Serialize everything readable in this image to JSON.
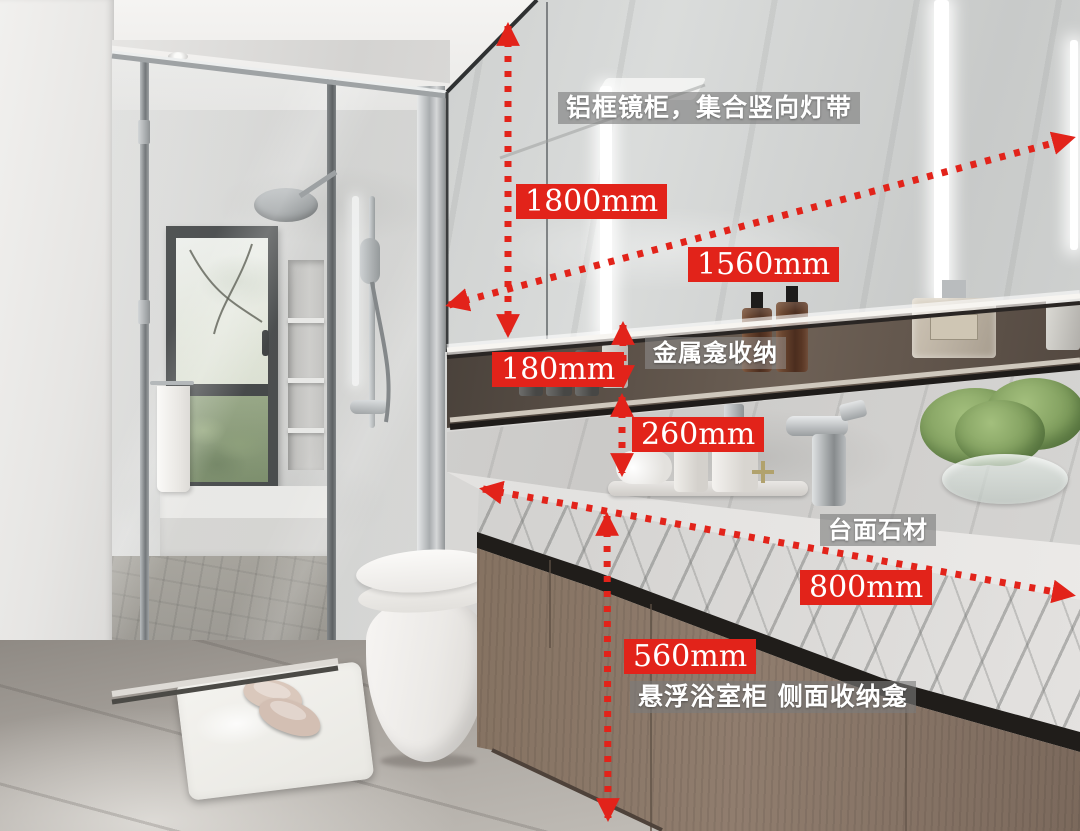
{
  "page": {
    "kind": "annotated bathroom interior photo",
    "accent_red": "#e2231a",
    "caption_text_color": "#ffffff"
  },
  "annotations": {
    "dimensions": [
      {
        "id": "mirror-cabinet-height",
        "label": "1800mm"
      },
      {
        "id": "mirror-cabinet-width",
        "label": "1560mm"
      },
      {
        "id": "metal-niche-height",
        "label": "180mm"
      },
      {
        "id": "splash-gap-height",
        "label": "260mm"
      },
      {
        "id": "countertop-width",
        "label": "800mm"
      },
      {
        "id": "vanity-cabinet-height",
        "label": "560mm"
      }
    ],
    "captions": [
      {
        "id": "mirror-cabinet-note",
        "text": "铝框镜柜，集合竖向灯带"
      },
      {
        "id": "metal-niche-note",
        "text": "金属龛收纳"
      },
      {
        "id": "countertop-note",
        "text": "台面石材"
      },
      {
        "id": "vanity-note",
        "text": "悬浮浴室柜 侧面收纳龛"
      }
    ]
  }
}
